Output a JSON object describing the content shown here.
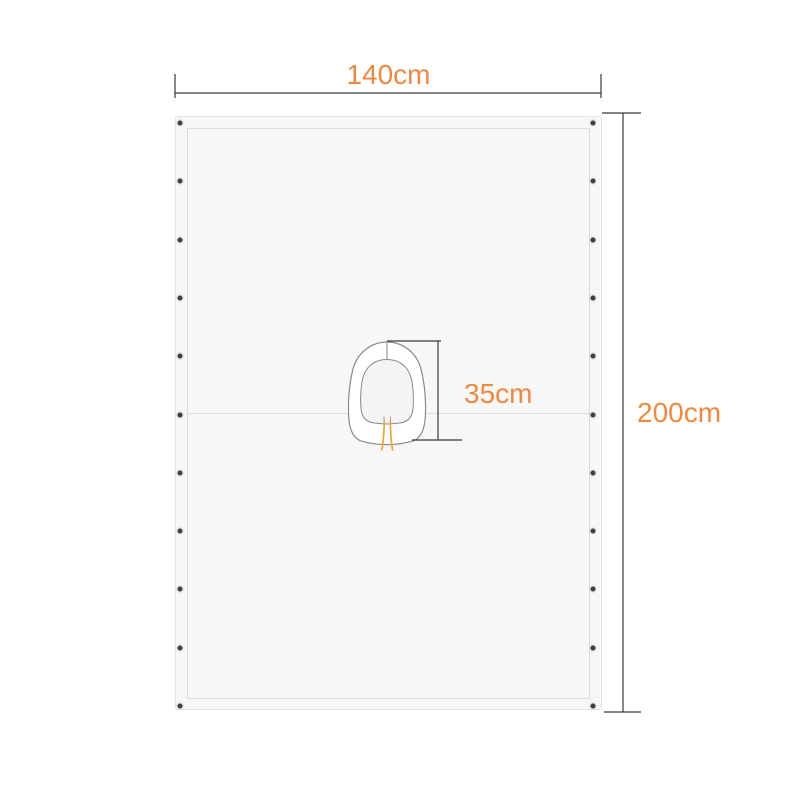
{
  "page": {
    "background_color": "#ffffff"
  },
  "diagram": {
    "type": "product-dimension-diagram",
    "subject": "cover sheet with center hood and drawstrings",
    "labels": {
      "width": "140cm",
      "height": "200cm",
      "hood": "35cm"
    },
    "grommets": {
      "per_side": 11,
      "sides": [
        "left",
        "right"
      ]
    },
    "colors": {
      "label_orange": "#f0883e",
      "dimension_line": "#3a3a3a",
      "sheet_fill": "#f7f7f7",
      "sheet_border": "#e3e3e3",
      "inner_border": "#dcdcdc",
      "seam_line": "#dedede",
      "grommet": "#3f3f3f",
      "hood_outline": "#8a8a8a",
      "hood_fill": "#ffffff",
      "hood_inner_fill": "#f4f4f4",
      "drawstring": "#f2a43a",
      "page_bg": "#ffffff"
    }
  }
}
